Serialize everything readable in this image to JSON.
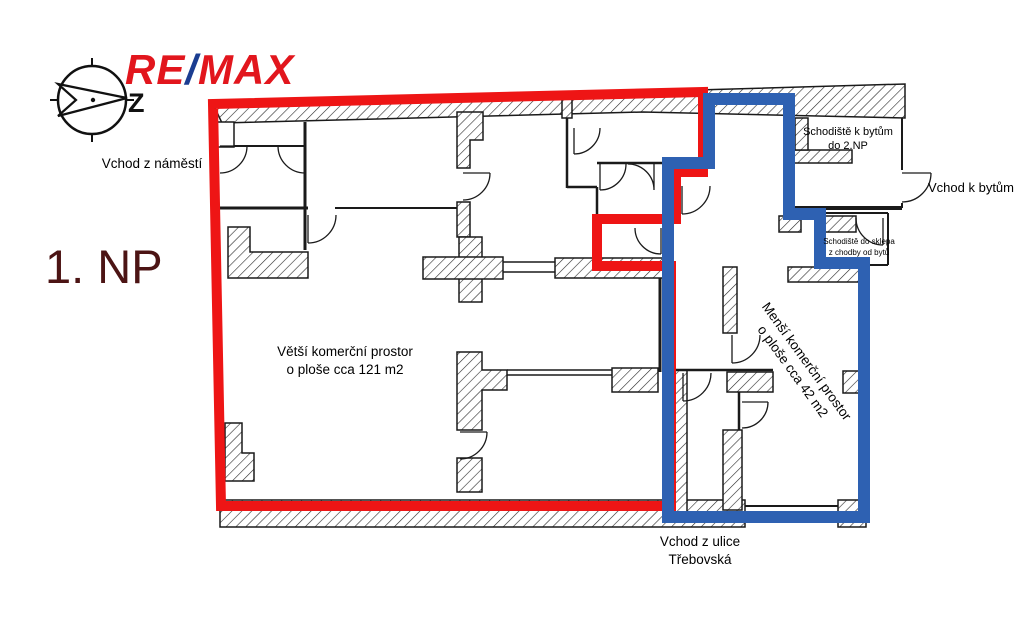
{
  "logo": {
    "part1": "RE",
    "slash": "/",
    "part2": "MAX"
  },
  "floor_label": "1. NP",
  "compass": {
    "letter": "Z"
  },
  "annotations": {
    "entrance_square": "Vchod z náměstí",
    "larger_space_line1": "Větší komerční prostor",
    "larger_space_line2": "o ploše cca 121 m2",
    "smaller_space_line1": "Menší komerční prostor",
    "smaller_space_line2": "o ploše cca 42 m2",
    "stairs_apartments_line1": "Schodiště k bytům",
    "stairs_apartments_line2": "do 2.NP",
    "entrance_apartments": "Vchod k bytům",
    "stairs_basement_line1": "Schodiště do sklepa",
    "stairs_basement_line2": "z chodby od bytů",
    "entrance_street_line1": "Vchod z ulice",
    "entrance_street_line2": "Třebovská"
  },
  "colors": {
    "larger_space_outline": "#ee1515",
    "smaller_space_outline": "#2e61b2",
    "logo_red": "#e2161d",
    "logo_blue": "#1b3d91",
    "floor_label_color": "#4c1414",
    "wall_line": "#1a1a1a"
  }
}
